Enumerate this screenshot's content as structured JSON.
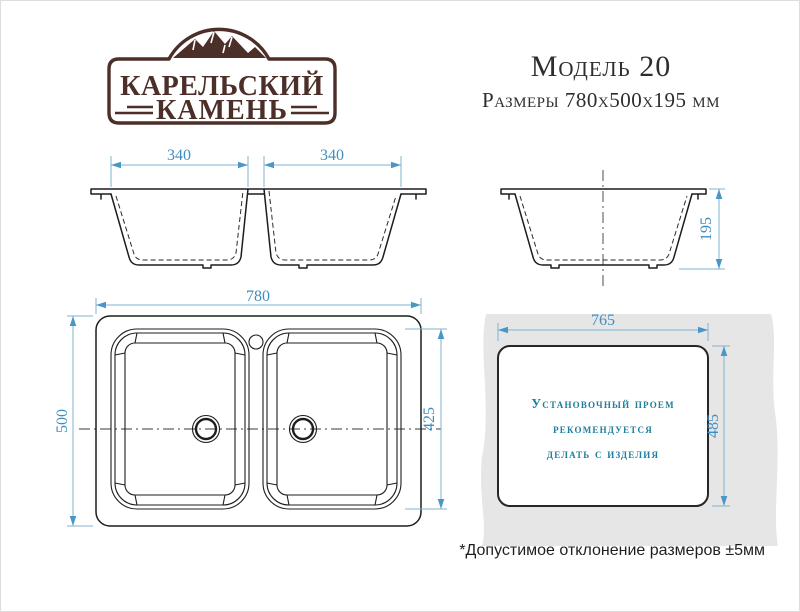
{
  "brand": {
    "name_line1": "КАРЕЛЬСКИЙ",
    "name_line2": "КАМЕНЬ"
  },
  "header": {
    "model": "Модель 20",
    "size_caption": "Размеры 780х500х195 мм"
  },
  "views": {
    "front": {
      "left_bowl_width": "340",
      "right_bowl_width": "340"
    },
    "side": {
      "height": "195"
    },
    "top": {
      "overall_width": "780",
      "overall_depth": "500",
      "bowl_depth": "425"
    },
    "cutout": {
      "width": "765",
      "depth": "485",
      "note_line1": "Установочный проем",
      "note_line2": "рекомендуется",
      "note_line3": "делать с изделия"
    }
  },
  "footnote": "*Допустимое отклонение размеров ±5мм",
  "colors": {
    "dimension_blue": "#4a97c6",
    "drawing_black": "#1d1d1d",
    "note_teal": "#1c7f9d",
    "brand_brown": "#4c2f28",
    "countertop_gray": "#e6e6e6"
  }
}
